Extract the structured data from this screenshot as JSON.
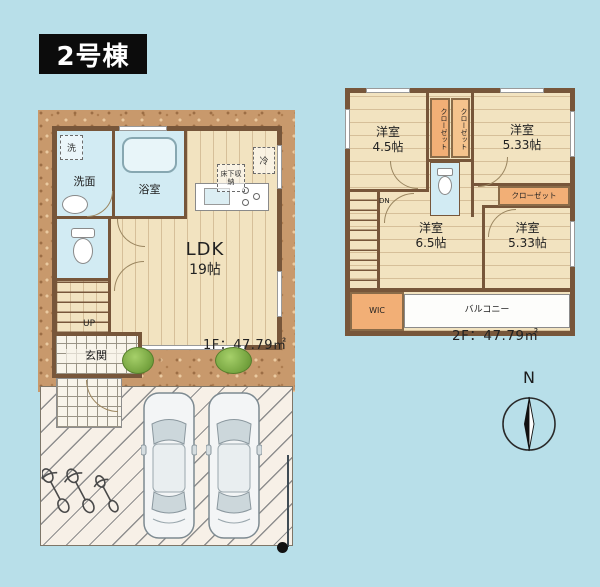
{
  "page": {
    "badge": "2号棟"
  },
  "floor1": {
    "area_label": "1F：47.79㎡",
    "ldk": {
      "name": "LDK",
      "size": "19帖"
    },
    "washroom": "洗面",
    "bath": "浴室",
    "laundry": "洗",
    "fridge": "冷",
    "underfloor_storage": "床下収納",
    "entrance": "玄関",
    "stairs_up": "UP"
  },
  "floor2": {
    "area_label": "2F：47.79㎡",
    "room_nw": {
      "name": "洋室",
      "size": "4.5帖"
    },
    "room_ne": {
      "name": "洋室",
      "size": "5.33帖"
    },
    "room_center": {
      "name": "洋室",
      "size": "6.5帖"
    },
    "room_se": {
      "name": "洋室",
      "size": "5.33帖"
    },
    "closet_a": "クローゼット",
    "closet_b": "クローゼット",
    "closet_c": "クローゼット",
    "wic": "WIC",
    "balcony": "バルコニー",
    "stairs_down": "DN"
  },
  "compass": {
    "north": "N"
  },
  "colors": {
    "background": "#b8dfe9",
    "ground": "#c8996c",
    "wall": "#77563a",
    "floor_wood": "#f2e3c0",
    "wet_room": "#d2ebf3",
    "closet": "#f2af76",
    "badge_bg": "#0c0c0c"
  }
}
